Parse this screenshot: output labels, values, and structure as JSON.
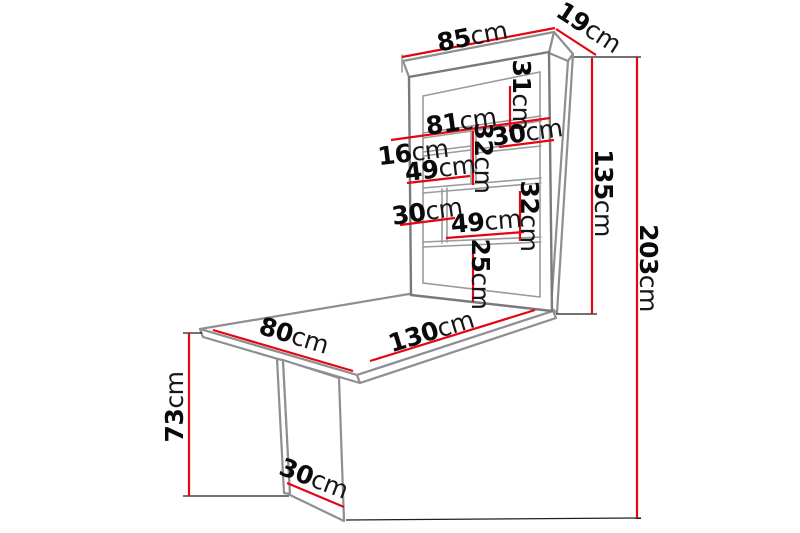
{
  "figure": {
    "kind": "furniture-dimension-diagram",
    "subject": "fold-out wall desk with shelf unit and leg panel",
    "unit": "cm",
    "colors": {
      "background": "#ffffff",
      "dimension_line": "#e30613",
      "furniture_outline": "#8f8f8f",
      "extension_line": "#1f1f1f",
      "label_text": "#0a0a0a"
    },
    "dimensions": {
      "cabinet_width": {
        "value": "85",
        "unit": "cm"
      },
      "cabinet_depth": {
        "value": "19",
        "unit": "cm"
      },
      "top_compartment_height": {
        "value": "31",
        "unit": "cm"
      },
      "inner_shelf_width": {
        "value": "81",
        "unit": "cm"
      },
      "small_gap_height": {
        "value": "16",
        "unit": "cm"
      },
      "row2_left_width": {
        "value": "49",
        "unit": "cm"
      },
      "row2_height": {
        "value": "32",
        "unit": "cm"
      },
      "row2_right_width": {
        "value": "30",
        "unit": "cm"
      },
      "row3_left_width": {
        "value": "30",
        "unit": "cm"
      },
      "row3_right_width": {
        "value": "49",
        "unit": "cm"
      },
      "row3_height": {
        "value": "32",
        "unit": "cm"
      },
      "bottom_compartment_height": {
        "value": "25",
        "unit": "cm"
      },
      "cabinet_height": {
        "value": "135",
        "unit": "cm"
      },
      "overall_height": {
        "value": "203",
        "unit": "cm"
      },
      "table_width": {
        "value": "80",
        "unit": "cm"
      },
      "table_length": {
        "value": "130",
        "unit": "cm"
      },
      "table_height": {
        "value": "73",
        "unit": "cm"
      },
      "leg_panel_width": {
        "value": "30",
        "unit": "cm"
      }
    }
  }
}
